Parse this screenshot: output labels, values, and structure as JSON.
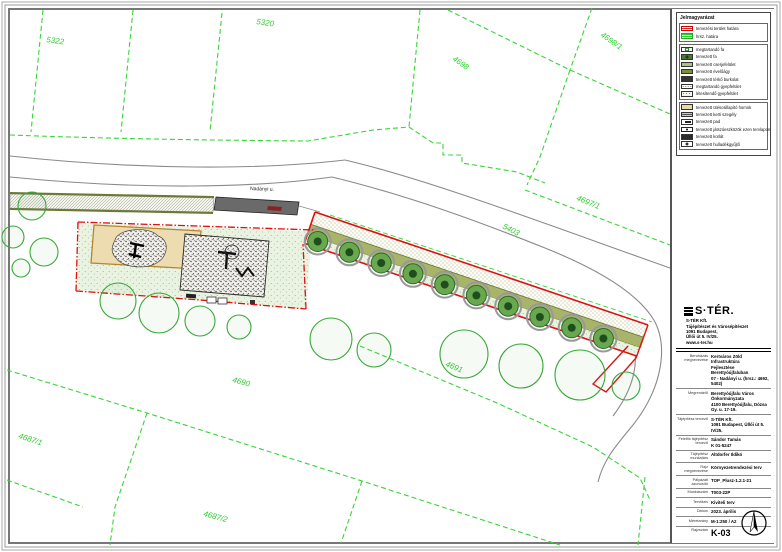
{
  "legend": {
    "title": "Jelmagyarázat",
    "items": [
      {
        "label": "tervezési terület határa",
        "swatch": "red-stripes"
      },
      {
        "label": "hrsz. határa",
        "swatch": "green-stripes"
      },
      {
        "label": "megtartandó fa",
        "swatch": "tree-existing"
      },
      {
        "label": "tervezett fa",
        "swatch": "tree-planned"
      },
      {
        "label": "tervezett cserjefelület",
        "swatch": "shrub"
      },
      {
        "label": "tervezett évelőágy",
        "swatch": "perennial-bed"
      },
      {
        "label": "tervezett térkő burkolat",
        "swatch": "paving"
      },
      {
        "label": "megtartandó gyepfelület",
        "swatch": "grass-existing"
      },
      {
        "label": "létesítendő gyepfelület",
        "swatch": "grass-new"
      },
      {
        "label": "tervezett ütéscsillapító homok",
        "swatch": "sand"
      },
      {
        "label": "tervezett kerti szegély",
        "swatch": "edge"
      },
      {
        "label": "tervezett pad",
        "swatch": "bench"
      },
      {
        "label": "tervezett játszóeszközök ezen tervlapon",
        "swatch": "play-equipment"
      },
      {
        "label": "tervezett korlát",
        "swatch": "railing"
      },
      {
        "label": "tervezett hulladékgyűjtő",
        "swatch": "litter-bin"
      }
    ]
  },
  "titleblock": {
    "logo": "S·TÉR.",
    "logo_lines": [
      "S-TÉR Kft.",
      "Tájépítészet és Városépítészet",
      "1091 Budapest,",
      "Üllői út 5. IV/25.",
      "www.s-ter.hu"
    ],
    "rows": [
      {
        "label": "Beruházás megnevezése",
        "values": [
          "Kertváros Zöld Infrastruktúra",
          "Fejlesztése Berettyóújfaluban",
          "07 - Nadányi u. (hrsz.: 4692, 5402)"
        ]
      },
      {
        "label": "Megrendelő",
        "values": [
          "Berettyóújfalu Város Önkormányzata",
          "4100 Berettyóújfalu, Dózsa Gy. u. 17-19."
        ]
      },
      {
        "label": "Tájépítész tervező",
        "values": [
          "S-TÉR Kft.",
          "1091 Budapest, Üllői út 5. IV/25."
        ]
      },
      {
        "label": "Felelős tájépítész tervező",
        "values": [
          "Sándor Tamás",
          "K 01-5247"
        ]
      },
      {
        "label": "Tájépítész munkatárs",
        "values": [
          "Altdorfer Ildikó"
        ]
      },
      {
        "label": "Rajz megnevezése",
        "values": [
          "Környezetrendezési terv"
        ]
      },
      {
        "label": "Pályázati azonosító",
        "values": [
          "TOP_Plusz-1.2.1-21"
        ]
      },
      {
        "label": "Munkaszám",
        "values": [
          "T003-22P"
        ]
      },
      {
        "label": "Tervfázis",
        "values": [
          "Kiviteli terv"
        ]
      },
      {
        "label": "Dátum",
        "values": [
          "2023. április"
        ]
      },
      {
        "label": "Méretarány",
        "values": [
          "M-1:250 / A2"
        ]
      },
      {
        "label": "Rajzszám",
        "values": [
          "K-03"
        ]
      }
    ]
  },
  "map": {
    "parcels": [
      {
        "label": "5322"
      },
      {
        "label": "5320"
      },
      {
        "label": "4698"
      },
      {
        "label": "4698/1"
      },
      {
        "label": "4697/1"
      },
      {
        "label": "5403"
      },
      {
        "label": "4691"
      },
      {
        "label": "4690"
      },
      {
        "label": "4687/1"
      },
      {
        "label": "4687/2"
      }
    ],
    "roads": [
      {
        "label": "Nadányi u."
      }
    ],
    "colors": {
      "parcel_line": "#39d439",
      "boundary_red": "#dd1111",
      "planting_olive": "#a7b46a",
      "tree_green": "#6aa84f",
      "road_gray": "#8a8a8a"
    }
  }
}
